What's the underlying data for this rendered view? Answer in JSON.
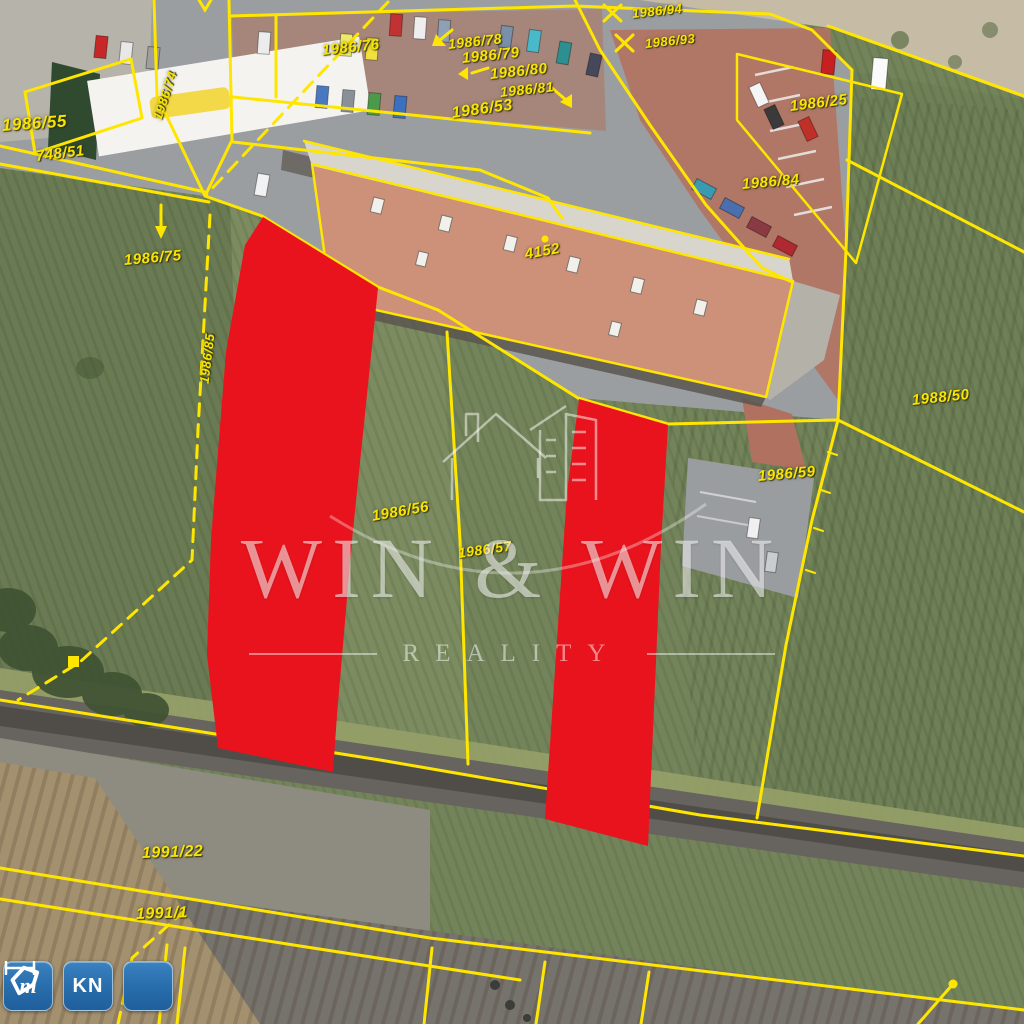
{
  "map": {
    "line_color": "#ffe600",
    "highlight_color": "#e8131c",
    "parcel_labels": [
      {
        "text": "1986/55",
        "x": 2,
        "y": 116,
        "rot": -4,
        "size": 17
      },
      {
        "text": "748/51",
        "x": 36,
        "y": 148,
        "rot": -7,
        "size": 15
      },
      {
        "text": "1986/74",
        "x": 157,
        "y": 112,
        "rot": -72,
        "size": 13
      },
      {
        "text": "1986/94",
        "x": 632,
        "y": 6,
        "rot": -6,
        "size": 13
      },
      {
        "text": "1986/93",
        "x": 645,
        "y": 36,
        "rot": -6,
        "size": 13
      },
      {
        "text": "1986/76",
        "x": 322,
        "y": 42,
        "rot": -6,
        "size": 15
      },
      {
        "text": "1986/78",
        "x": 448,
        "y": 36,
        "rot": -6,
        "size": 14
      },
      {
        "text": "1986/79",
        "x": 462,
        "y": 50,
        "rot": -6,
        "size": 15
      },
      {
        "text": "1986/80",
        "x": 490,
        "y": 66,
        "rot": -6,
        "size": 15
      },
      {
        "text": "1986/81",
        "x": 500,
        "y": 84,
        "rot": -6,
        "size": 14
      },
      {
        "text": "1986/53",
        "x": 452,
        "y": 105,
        "rot": -8,
        "size": 16
      },
      {
        "text": "1986/25",
        "x": 790,
        "y": 98,
        "rot": -7,
        "size": 15
      },
      {
        "text": "1986/84",
        "x": 742,
        "y": 176,
        "rot": -5,
        "size": 15
      },
      {
        "text": "1986/75",
        "x": 124,
        "y": 252,
        "rot": -5,
        "size": 15
      },
      {
        "text": "1986/85",
        "x": 204,
        "y": 376,
        "rot": -83,
        "size": 13
      },
      {
        "text": "4152",
        "x": 525,
        "y": 246,
        "rot": -10,
        "size": 15
      },
      {
        "text": "1988/50",
        "x": 912,
        "y": 392,
        "rot": -6,
        "size": 15
      },
      {
        "text": "1986/59",
        "x": 758,
        "y": 468,
        "rot": -5,
        "size": 15
      },
      {
        "text": "1986/56",
        "x": 372,
        "y": 508,
        "rot": -10,
        "size": 15
      },
      {
        "text": "1986/57",
        "x": 458,
        "y": 545,
        "rot": -8,
        "size": 14
      },
      {
        "text": "1991/22",
        "x": 142,
        "y": 845,
        "rot": -2,
        "size": 16
      },
      {
        "text": "1991/1",
        "x": 136,
        "y": 906,
        "rot": -2,
        "size": 16
      }
    ]
  },
  "watermark": {
    "line1": "WIN & WIN",
    "line2": "REALITY"
  },
  "controls": {
    "measure": {
      "label": "m"
    },
    "kn": {
      "label": "KN"
    },
    "polygon_tool": {
      "label": ""
    }
  }
}
